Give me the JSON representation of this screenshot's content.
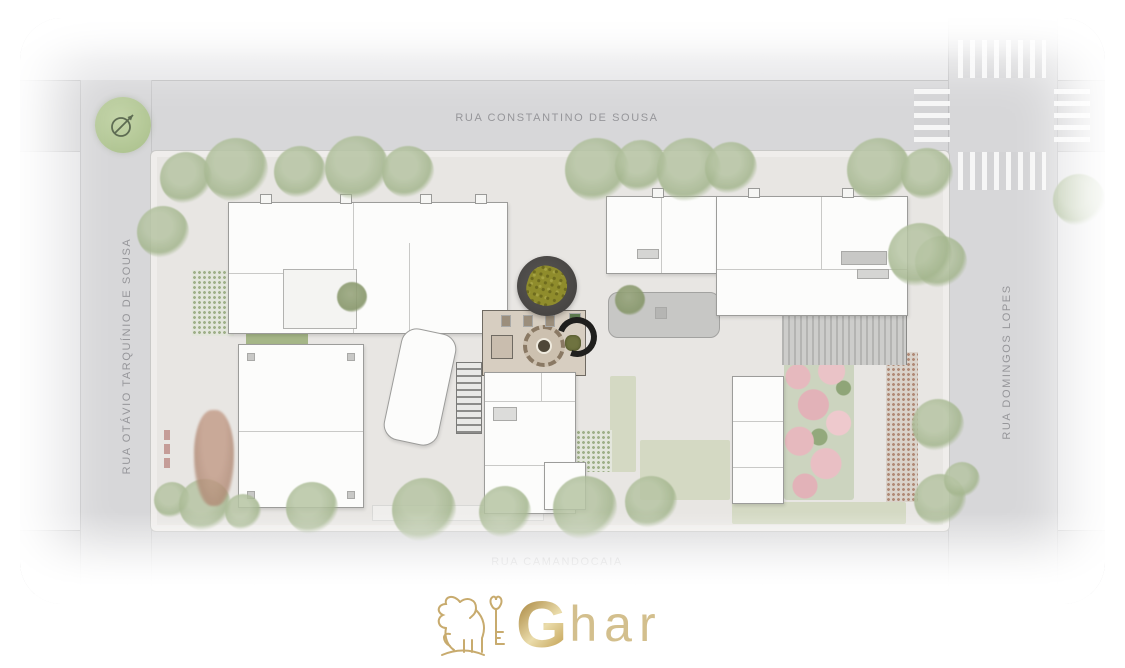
{
  "site_plan": {
    "streets": {
      "top": "RUA CONSTANTINO DE SOUSA",
      "left": "RUA OTÁVIO TARQUÍNIO DE SOUSA",
      "right": "RUA DOMINGOS LOPES",
      "bottom": "RUA CAMANDOCAIA"
    },
    "compass": {
      "icon": "north-arrow-icon"
    },
    "features": {
      "central_plaza": "circular dark plaza with tree",
      "pink_garden": "flowering garden",
      "crosswalk": "striped pedestrian crossings at north-east intersection"
    },
    "colors": {
      "street": "#d7d7d9",
      "sidewalk": "#e5e5e7",
      "parcel": "#e8e6e3",
      "building": "#fcfcfb",
      "tree": "#a4b68e",
      "plaza": "#4b4947",
      "plaza_tree": "#8f8c2c",
      "pink_garden": "#e6b9be",
      "compass_green": "#b9cc9c",
      "gold": "#c9a45f"
    }
  },
  "logo": {
    "mark": "lion-with-key-icon",
    "brand_initial": "G",
    "brand_rest": "har"
  }
}
